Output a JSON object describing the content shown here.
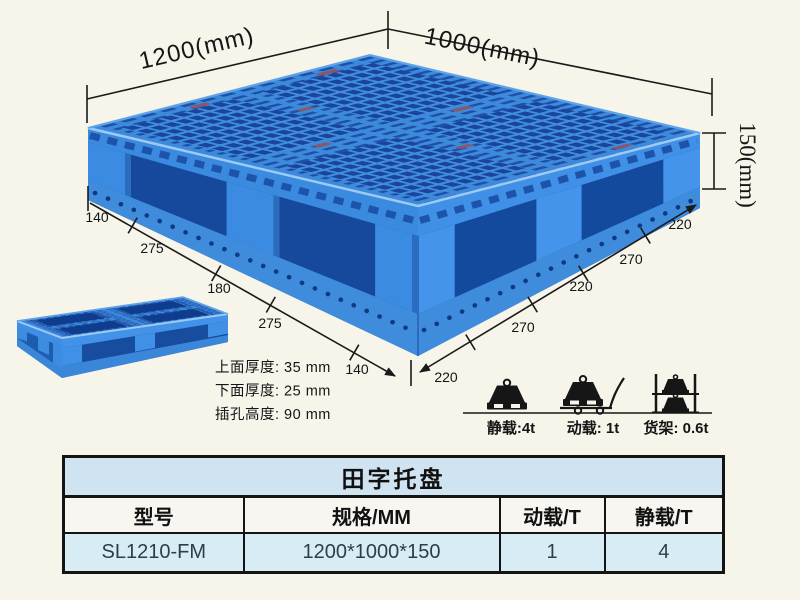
{
  "diagram": {
    "top_length_label": "1200(mm)",
    "top_width_label": "1000(mm)",
    "height_label": "150(mm)",
    "bottom_left_dims": [
      "140",
      "275",
      "180",
      "275",
      "140"
    ],
    "bottom_right_dims": [
      "220",
      "270",
      "220",
      "270",
      "220"
    ],
    "thickness_notes": [
      "上面厚度: 35 mm",
      "下面厚度: 25 mm",
      "插孔高度: 90 mm"
    ],
    "load_ratings": [
      {
        "icon": "static-load-weight-icon",
        "label": "静载:4t"
      },
      {
        "icon": "dynamic-load-trolley-icon",
        "label": "动载: 1t"
      },
      {
        "icon": "rack-load-shelf-icon",
        "label": "货架: 0.6t"
      }
    ]
  },
  "spec_table": {
    "title": "田字托盘",
    "columns": [
      "型号",
      "规格/MM",
      "动载/T",
      "静载/T"
    ],
    "rows": [
      {
        "model": "SL1210-FM",
        "spec": "1200*1000*150",
        "dynamic_load": "1",
        "static_load": "4"
      }
    ]
  },
  "colors": {
    "background": "#f7f4ea",
    "pallet_blue": "#2f7fd6",
    "pallet_dark_blue": "#16479e",
    "pallet_light_blue": "#4a95e6",
    "table_title_bg": "#cfe4f0",
    "table_header_bg": "#f7f6f1",
    "table_row_bg": "#d8ecf6",
    "line_color": "#1a1a1a"
  }
}
